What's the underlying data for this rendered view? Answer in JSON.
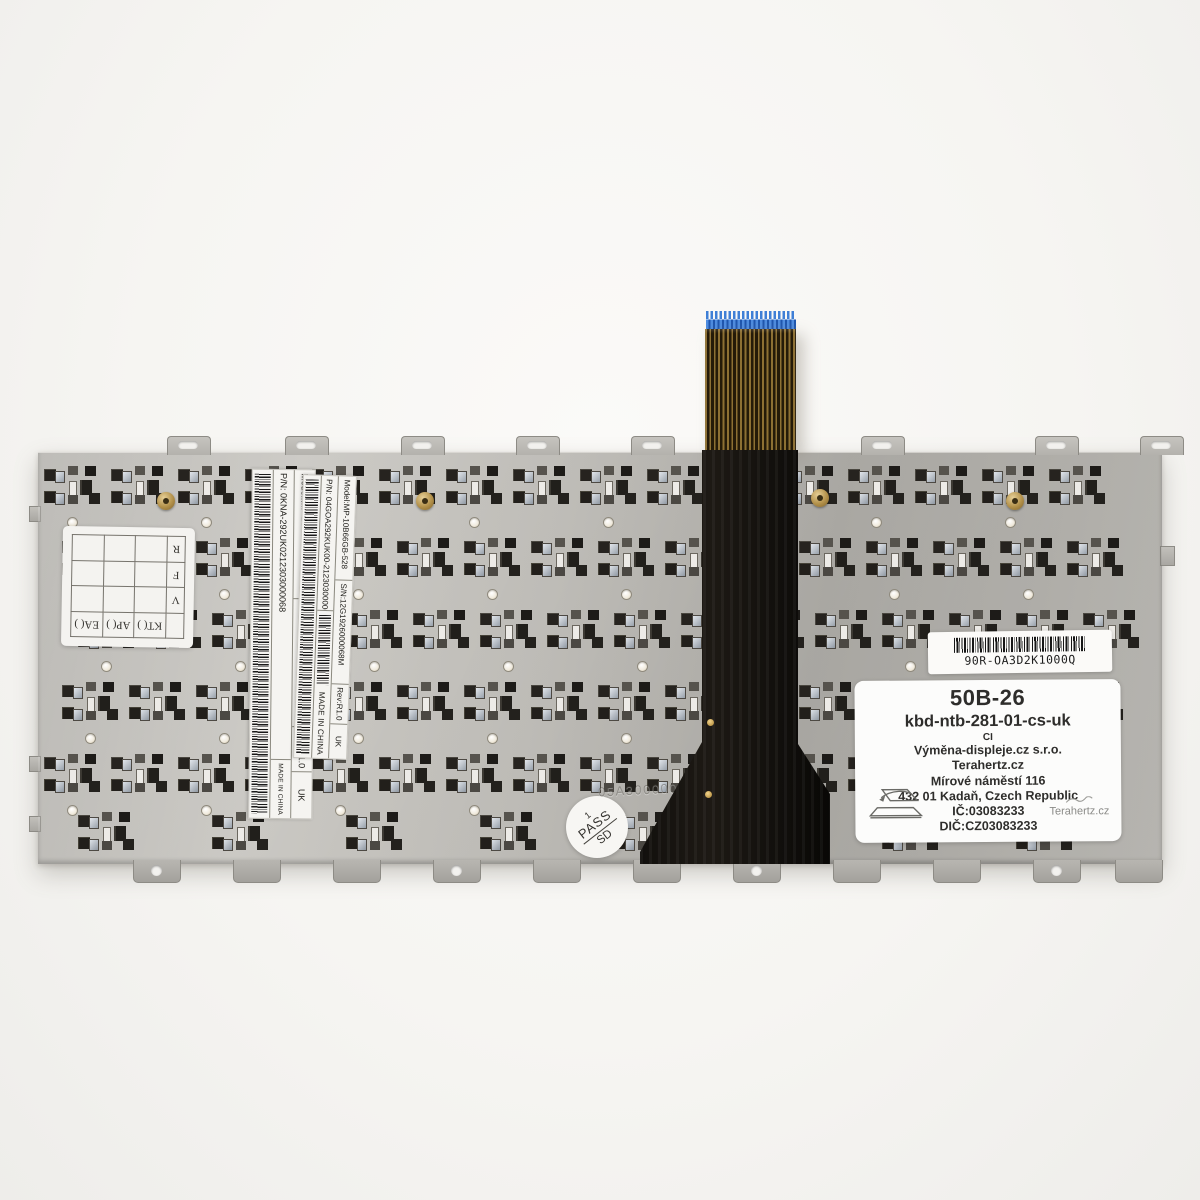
{
  "stickers": {
    "label_outer": {
      "model": "Model:MP-10B66GB-528",
      "serial": "S/N:12G1926000068M",
      "rev": "Rev:R1.0",
      "region": "UK",
      "part": "P/N: 0KNA-292UK0212303000068",
      "origin": "MADE IN CHINA"
    },
    "label_inner": {
      "model": "Model:MP-10B66GB-528",
      "serial": "S/N:12G1926000068M",
      "rev": "Rev:R1.0",
      "region": "UK",
      "part": "P/N: 04GOA292KUK00-212303000068",
      "origin": "MADE IN CHINA"
    },
    "barcode_sticker": {
      "code": "90R-OA3D2K1000Q"
    },
    "shop": {
      "code": "50B-26",
      "product": "kbd-ntb-281-01-cs-uk",
      "line3": "CI",
      "company": "Výměna-displeje.cz s.r.o.",
      "site": "Terahertz.cz",
      "street": "Mírové náměstí 116",
      "city": "432 01 Kadaň, Czech Republic",
      "ic": "IČ:03083233",
      "dic": "DIČ:CZ03083233",
      "signature": "Terahertz.cz"
    },
    "pass": {
      "top": "1",
      "middle": "PASS",
      "bottom": "SD"
    },
    "grid": {
      "right_column": [
        "R",
        "F",
        "V"
      ],
      "bottom_row": [
        "EA( )",
        "AP( )",
        "KT( )"
      ]
    },
    "etched": "05A300000U0 1 01"
  }
}
